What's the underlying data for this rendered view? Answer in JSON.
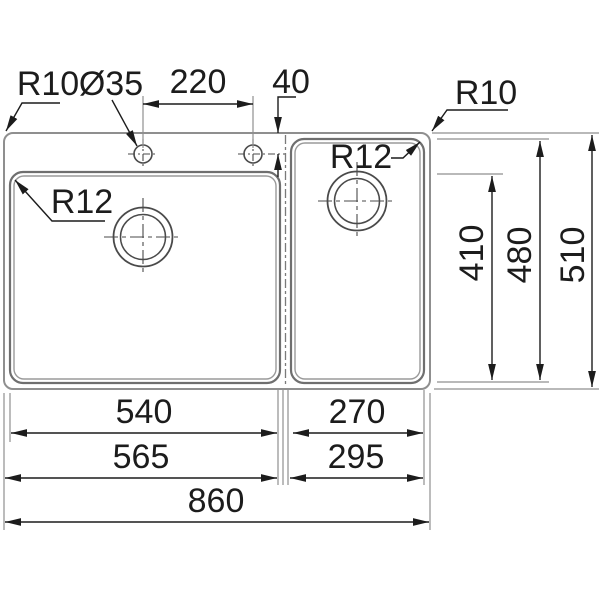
{
  "diagram": {
    "type": "technical-drawing",
    "subject": "Double-bowl kitchen sink dimensioned top-view drawing",
    "background": "#ffffff",
    "colors": {
      "outline_gray": "#8f8f8f",
      "bowl_gray": "#6f6f6f",
      "dimension_black": "#1c1c1c"
    },
    "labels": {
      "corner_radius_left": "R10",
      "tap_hole_diameter": "Ø35",
      "tap_hole_spacing": "220",
      "tap_hole_edge_offset": "40",
      "corner_radius_right": "R10",
      "left_bowl_radius": "R12",
      "right_bowl_radius": "R12",
      "left_bowl_depth": "410",
      "right_bowl_depth": "480",
      "overall_depth": "510",
      "left_bowl_width": "540",
      "right_bowl_width": "270",
      "left_section_width": "565",
      "right_section_width": "295",
      "overall_width": "860"
    }
  }
}
